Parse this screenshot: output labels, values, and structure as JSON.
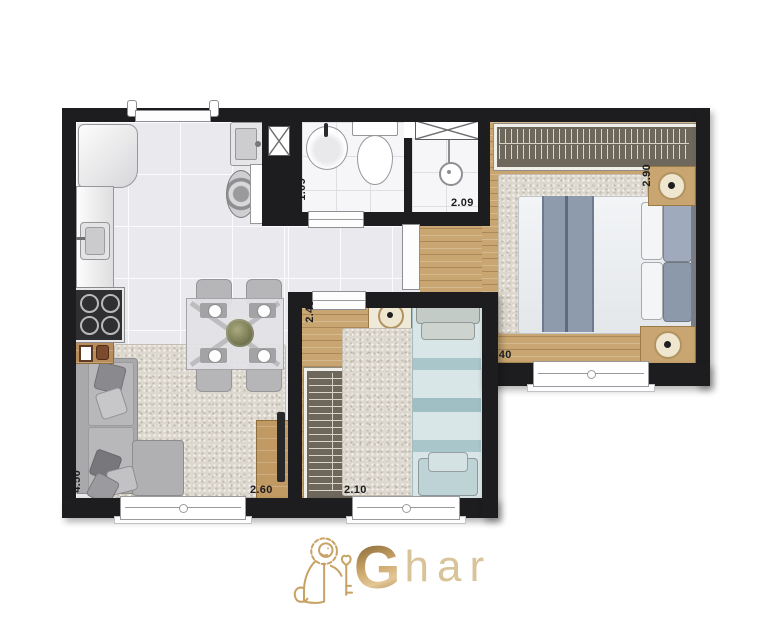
{
  "brand": {
    "g": "G",
    "rest": "har"
  },
  "icons": {
    "logo": "lion-key-icon",
    "duct": "crossed-duct-box",
    "bath_cabinet": "crossed-cabinet-box",
    "shower": "shower-head-icon",
    "lamp": "table-lamp-icon",
    "stove": "four-burner-stove-icon",
    "toilet": "toilet-icon",
    "washbasin": "washbasin-icon",
    "kitchen_sink": "kitchen-sink-icon",
    "laundry_sink": "laundry-sink-icon",
    "washer": "washing-machine-icon",
    "fridge": "refrigerator-icon"
  },
  "colors": {
    "wall": "#1d1d1f",
    "wood_floor": "#c9a671",
    "tile_floor": "#eaeaee",
    "rug": "#dcd8cf",
    "brand_gold": "#c2a06a",
    "double_bed_blanket": "#8e9bad",
    "single_bed": "#cfe0e2"
  },
  "floorplan": {
    "dims": {
      "bathroom_width": "1.09",
      "bathroom_total_width": "2.09",
      "bedroom1_depth": "2.90",
      "bedroom1_width": "2.40",
      "bedroom2_depth": "2.40",
      "bedroom2_width": "2.10",
      "living_depth": "4.50",
      "living_width": "2.60"
    }
  }
}
